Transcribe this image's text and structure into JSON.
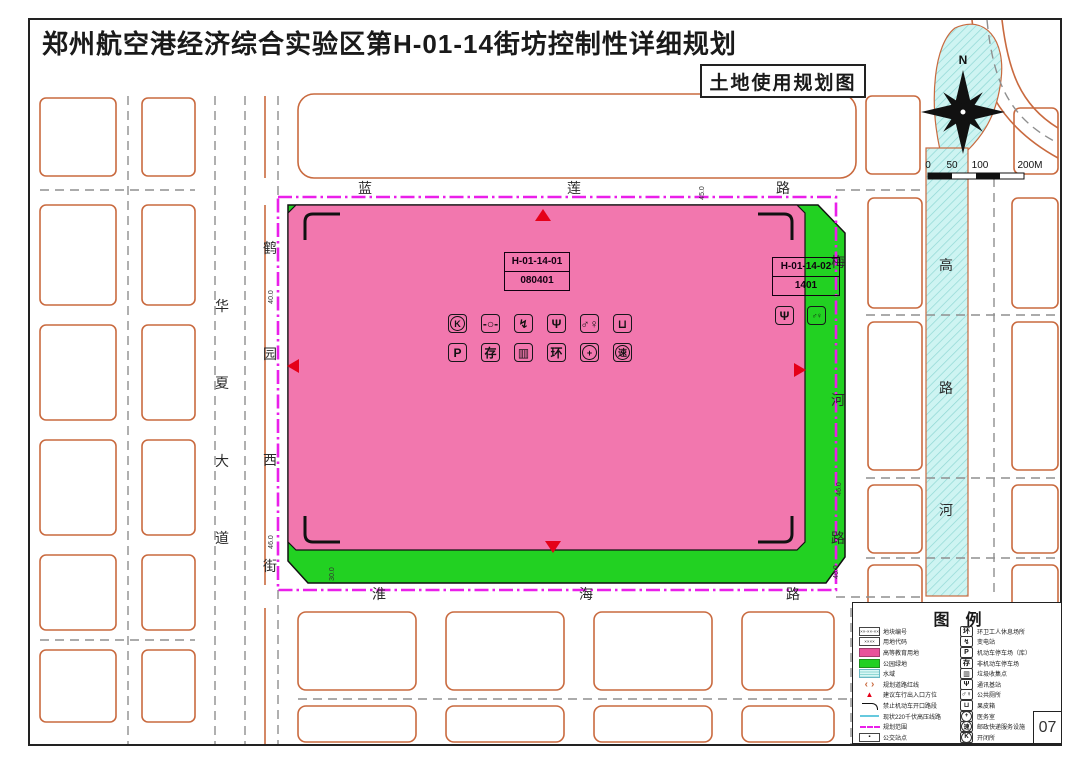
{
  "header": {
    "title": "郑州航空港经济综合实验区第H-01-14街坊控制性详细规划",
    "subtitle": "土地使用规划图"
  },
  "compass": {
    "north": "N"
  },
  "scale": {
    "ticks": [
      "0",
      "50",
      "100",
      "200M"
    ]
  },
  "map": {
    "road_names": {
      "lanlian": "蓝莲路",
      "huaihai": "淮海路",
      "huaxia": "华夏大道",
      "heyuanxi": "鹤园西街",
      "meihe": "梅河路",
      "river": "高路河"
    },
    "parcels": {
      "p1": {
        "id": "H-01-14-01",
        "code": "080401"
      },
      "p2": {
        "id": "H-01-14-02",
        "code": "1401"
      }
    },
    "dim_ticks": [
      "40.0",
      "46.0",
      "45.0",
      "46.0",
      "30.0",
      "46.0"
    ],
    "facility_icons": [
      {
        "name": "switch-station-icon",
        "glyph": "K",
        "inner": "circ"
      },
      {
        "name": "valve-icon",
        "glyph": "-○-",
        "cls": "sm"
      },
      {
        "name": "substation-icon",
        "glyph": "↯"
      },
      {
        "name": "telecom-tower-icon",
        "glyph": "Ψ"
      },
      {
        "name": "public-toilet-icon",
        "glyph": "♂♀",
        "cls": "sm"
      },
      {
        "name": "litter-bin-icon",
        "glyph": "⊔"
      },
      {
        "name": "parking-icon",
        "glyph": "P"
      },
      {
        "name": "bicycle-storage-icon",
        "glyph": "存"
      },
      {
        "name": "garbage-collection-icon",
        "glyph": "▥"
      },
      {
        "name": "sanitation-rest-icon",
        "glyph": "环"
      },
      {
        "name": "medical-icon",
        "glyph": "+",
        "inner": "circ"
      },
      {
        "name": "express-service-icon",
        "glyph": "速",
        "inner": "circ"
      }
    ],
    "spot_icons": [
      {
        "name": "telecom-tower-icon",
        "glyph": "Ψ"
      },
      {
        "name": "public-toilet-icon",
        "glyph": "♂♀",
        "cls": "sm"
      }
    ]
  },
  "legend": {
    "title": "图例",
    "left": [
      {
        "label": "地块编号",
        "swatch": "sw-numbox",
        "sample": "××-××-××"
      },
      {
        "label": "用地代码",
        "swatch": "sw-numbox",
        "sample": "××××"
      },
      {
        "label": "高等教育用地",
        "swatch": "sw-pink"
      },
      {
        "label": "公园绿地",
        "swatch": "sw-green"
      },
      {
        "label": "水域",
        "swatch": "sw-water"
      },
      {
        "label": "规划道路红线",
        "swatch": "sw-roadline"
      },
      {
        "label": "建议车行出入口方位",
        "swatch": "sw-entry"
      },
      {
        "label": "禁止机动车开口路段",
        "swatch": "sw-noopen"
      },
      {
        "label": "现状220千伏高压线路",
        "swatch": "sw-hv"
      },
      {
        "label": "规划范围",
        "swatch": "sw-bound"
      },
      {
        "label": "公交站点",
        "swatch": "sw-bus"
      }
    ],
    "right": [
      {
        "label": "环卫工人休息场所",
        "glyph": "环",
        "name": "sanitation-rest-icon"
      },
      {
        "label": "变电站",
        "glyph": "↯",
        "name": "substation-icon"
      },
      {
        "label": "机动车停车场（库）",
        "glyph": "P",
        "name": "parking-icon"
      },
      {
        "label": "非机动车停车场",
        "glyph": "存",
        "name": "bicycle-storage-icon"
      },
      {
        "label": "垃圾收集点",
        "glyph": "▥",
        "name": "garbage-collection-icon"
      },
      {
        "label": "通讯基站",
        "glyph": "Ψ",
        "name": "telecom-tower-icon"
      },
      {
        "label": "公共厕所",
        "glyph": "♂♀",
        "cls": "sm",
        "name": "public-toilet-icon"
      },
      {
        "label": "果皮箱",
        "glyph": "⊔",
        "name": "litter-bin-icon"
      },
      {
        "label": "医务室",
        "glyph": "+",
        "inner": "circ",
        "name": "medical-icon"
      },
      {
        "label": "邮政快递服务设施",
        "glyph": "速",
        "inner": "circ",
        "name": "express-service-icon"
      },
      {
        "label": "开闭所",
        "glyph": "K",
        "inner": "circ",
        "name": "switch-station-icon"
      }
    ]
  },
  "page_number": "07",
  "colors": {
    "parcel_pink": "#f277ae",
    "park_green": "#22d122",
    "boundary_magenta": "#ea1fea",
    "road_orange": "#c96a3f",
    "water_cyan": "#cef4f2",
    "entry_red": "#e50019"
  }
}
